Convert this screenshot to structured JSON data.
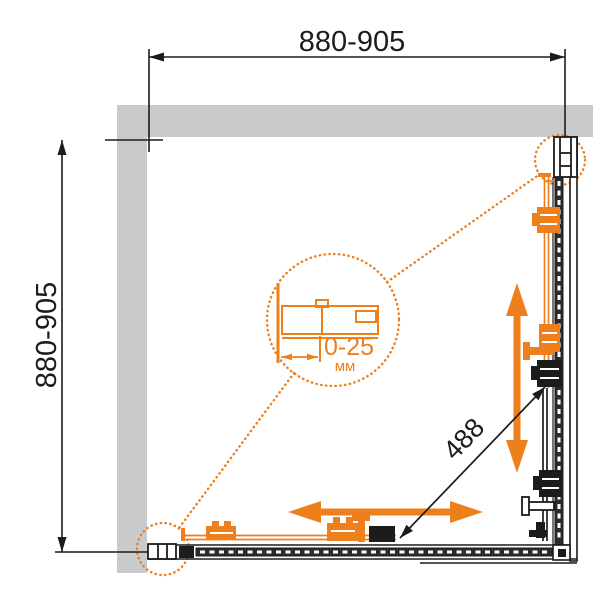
{
  "drawing": {
    "type": "shower-enclosure-plan-view-technical-drawing"
  },
  "dimensions": {
    "top_width": "880-905",
    "left_height": "880-905",
    "diagonal": "488",
    "detail_range": "0-25",
    "detail_unit": "мм"
  },
  "colors": {
    "accent_orange": "#ee7f1d",
    "wall_gray": "#c8cacc",
    "line_black": "#1c1c1c",
    "rail_dark": "#2b2b2b"
  }
}
